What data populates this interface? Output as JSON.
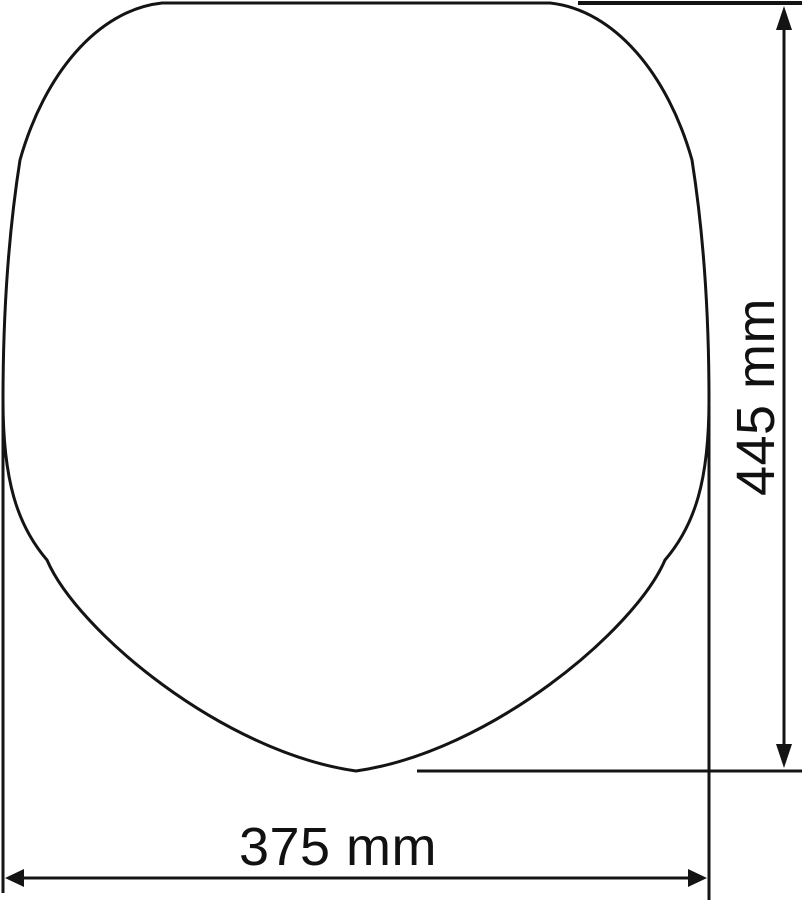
{
  "page": {
    "background": "#ffffff",
    "line_color": "#141414",
    "text_color": "#111111"
  },
  "diagram": {
    "subject": "toilet-seat-outline-dimension-drawing",
    "height_dimension": {
      "label": "445 mm"
    },
    "width_dimension": {
      "label": "375 mm"
    }
  }
}
